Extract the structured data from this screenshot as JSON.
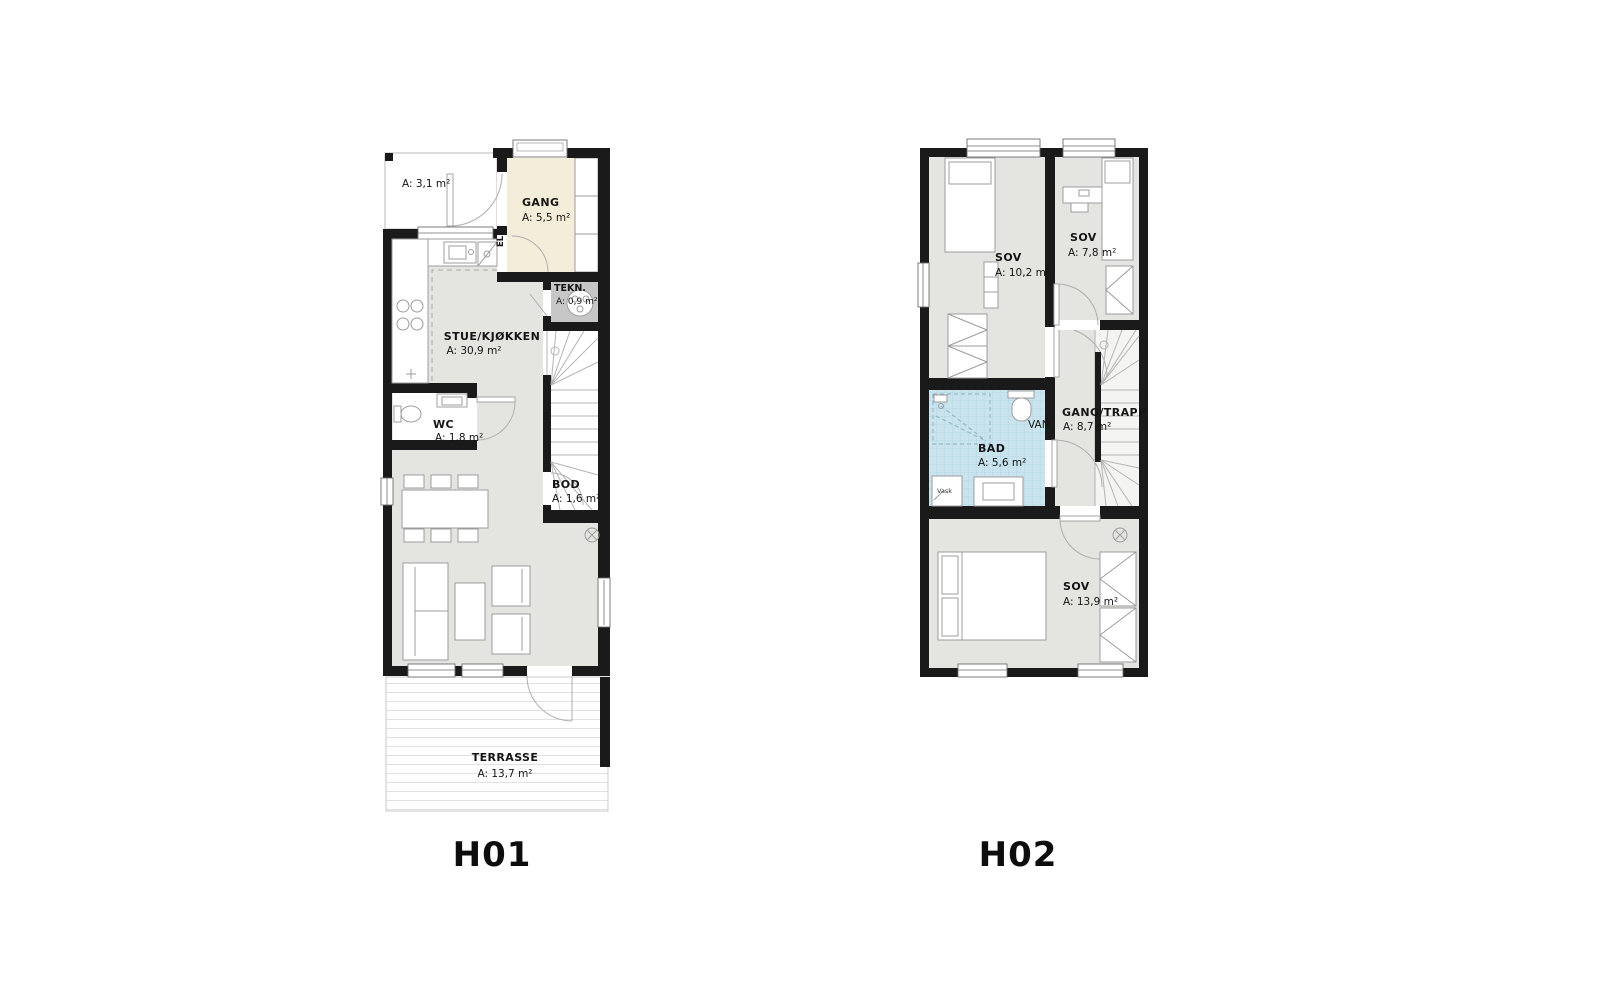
{
  "titles": {
    "h01": "H01",
    "h02": "H02"
  },
  "h01": {
    "porch": {
      "area": "A: 3,1 m²"
    },
    "gang": {
      "name": "GANG",
      "area": "A: 5,5 m²"
    },
    "tekn": {
      "name": "TEKN.",
      "area": "A: 0,9 m²"
    },
    "stue": {
      "name": "STUE/KJØKKEN",
      "area": "A: 30,9 m²"
    },
    "wc": {
      "name": "WC",
      "area": "A: 1,8 m²"
    },
    "bod": {
      "name": "BOD",
      "area": "A: 1,6 m²"
    },
    "terrasse": {
      "name": "TERRASSE",
      "area": "A: 13,7 m²"
    },
    "el_label": "EL"
  },
  "h02": {
    "sov1": {
      "name": "SOV",
      "area": "A: 10,2 m²"
    },
    "sov2": {
      "name": "SOV",
      "area": "A: 7,8 m²"
    },
    "gang_trapp": {
      "name": "GANG/TRAPP",
      "area": "A: 8,7 m²"
    },
    "bad": {
      "name": "BAD",
      "area": "A: 5,6 m²"
    },
    "sov3": {
      "name": "SOV",
      "area": "A: 13,9 m²"
    },
    "van_label": "VAN",
    "vask_label": "Vask"
  },
  "colors": {
    "wall": "#1a1a1a",
    "room_fill": "#e4e4e1",
    "gang_fill": "#f4edd9",
    "bad_fill": "#c9e4ee",
    "bad_grid": "#aed3e0",
    "tekn_fill": "#c7c7c7",
    "furniture_stroke": "#9c9c9c",
    "door_arc": "#aeaeae"
  }
}
